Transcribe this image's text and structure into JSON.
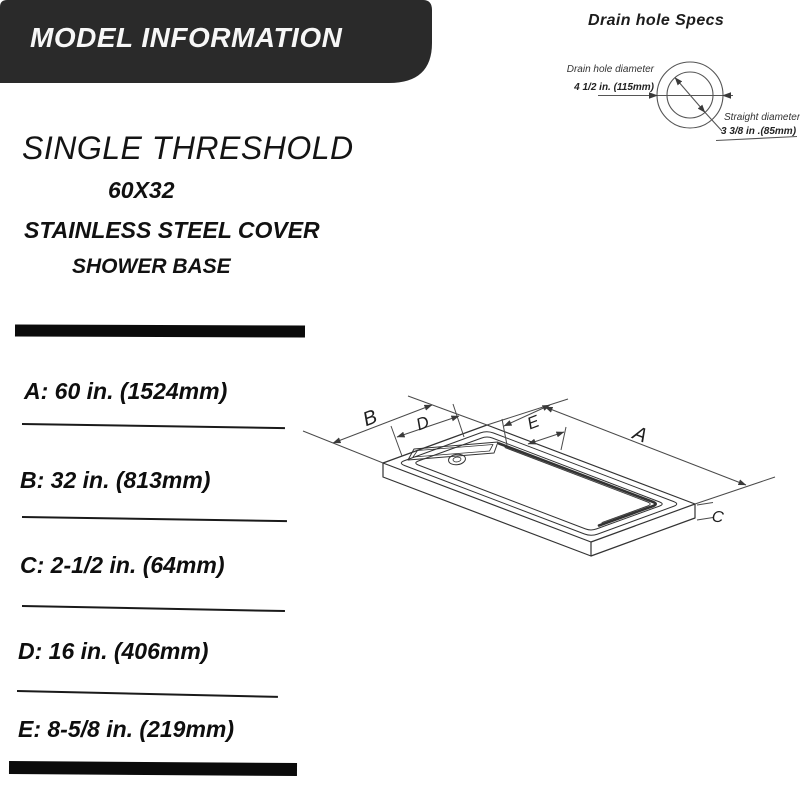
{
  "banner": {
    "title": "MODEL INFORMATION"
  },
  "product": {
    "title": "SINGLE THRESHOLD",
    "size": "60X32",
    "subtitle1": "STAINLESS STEEL COVER",
    "subtitle2": "SHOWER BASE"
  },
  "drain_specs": {
    "title": "Drain hole Specs",
    "hole_diameter_label": "Drain hole diameter",
    "hole_diameter_value": "4 1/2 in. (115mm)",
    "straight_diameter_label": "Straight diameter",
    "straight_diameter_value": "3 3/8 in .(85mm)"
  },
  "dimensions": {
    "items": [
      {
        "key": "A",
        "text": "A: 60 in. (1524mm)"
      },
      {
        "key": "B",
        "text": "B: 32 in. (813mm)"
      },
      {
        "key": "C",
        "text": "C: 2-1/2 in. (64mm)"
      },
      {
        "key": "D",
        "text": "D: 16 in. (406mm)"
      },
      {
        "key": "E",
        "text": "E: 8-5/8 in. (219mm)"
      }
    ]
  },
  "diagram": {
    "labels": {
      "a": "A",
      "b": "B",
      "c": "C",
      "d": "D",
      "e": "E"
    }
  },
  "colors": {
    "banner_bg": "#2a2a2a",
    "ink": "#111111",
    "line": "#4a4a4a"
  }
}
